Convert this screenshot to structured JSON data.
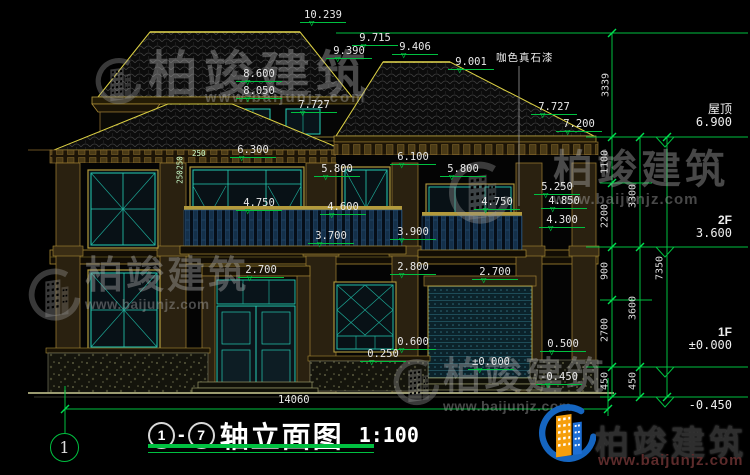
{
  "drawing": {
    "title": {
      "axis_start": "1",
      "axis_sep": "-",
      "axis_end": "7",
      "text": "轴立面图",
      "scale": "1:100"
    },
    "axis_bubble": "1",
    "overall_width": "14060",
    "material_note": "咖色真石漆"
  },
  "elevation_markers": [
    {
      "value": "10.239"
    },
    {
      "value": "9.715"
    },
    {
      "value": "9.390"
    },
    {
      "value": "9.406"
    },
    {
      "value": "9.001"
    },
    {
      "value": "8.600"
    },
    {
      "value": "8.050"
    },
    {
      "value": "7.727"
    },
    {
      "value": "7.727"
    },
    {
      "value": "7.200"
    },
    {
      "value": "6.300"
    },
    {
      "value": "6.100"
    },
    {
      "value": "5.800"
    },
    {
      "value": "5.800"
    },
    {
      "value": "5.250"
    },
    {
      "value": "4.850"
    },
    {
      "value": "4.300"
    },
    {
      "value": "4.750"
    },
    {
      "value": "4.750"
    },
    {
      "value": "4.600"
    },
    {
      "value": "3.700"
    },
    {
      "value": "3.900"
    },
    {
      "value": "2.700"
    },
    {
      "value": "2.800"
    },
    {
      "value": "2.700"
    },
    {
      "value": "0.600"
    },
    {
      "value": "0.250"
    },
    {
      "value": "0.500"
    },
    {
      "value": "±0.000"
    },
    {
      "value": "-0.450"
    }
  ],
  "small_dims": {
    "v1": "250",
    "v2": "250",
    "h1": "250"
  },
  "right_dims": {
    "top_chain": "3339",
    "inner": [
      {
        "value": "1100"
      },
      {
        "value": "2200"
      },
      {
        "value": "900"
      },
      {
        "value": "2700"
      },
      {
        "value": "450"
      }
    ],
    "middle": [
      {
        "value": "3300"
      },
      {
        "value": "3600"
      },
      {
        "value": "450"
      }
    ],
    "outer": "7350",
    "levels": [
      {
        "name": "屋顶",
        "elev": "6.900"
      },
      {
        "name": "2F",
        "elev": "3.600"
      },
      {
        "name": "1F",
        "elev": "±0.000"
      },
      {
        "name": "",
        "elev": "-0.450"
      }
    ]
  },
  "watermark": {
    "name": "柏竣建筑",
    "url": "www.baijunjz.com"
  },
  "colors": {
    "dim_green": "#00c040",
    "cad_yellow": "#cfc53e",
    "window_teal": "#25cdb4",
    "logo_blue": "#1565c0",
    "logo_orange": "#f59e0b"
  }
}
